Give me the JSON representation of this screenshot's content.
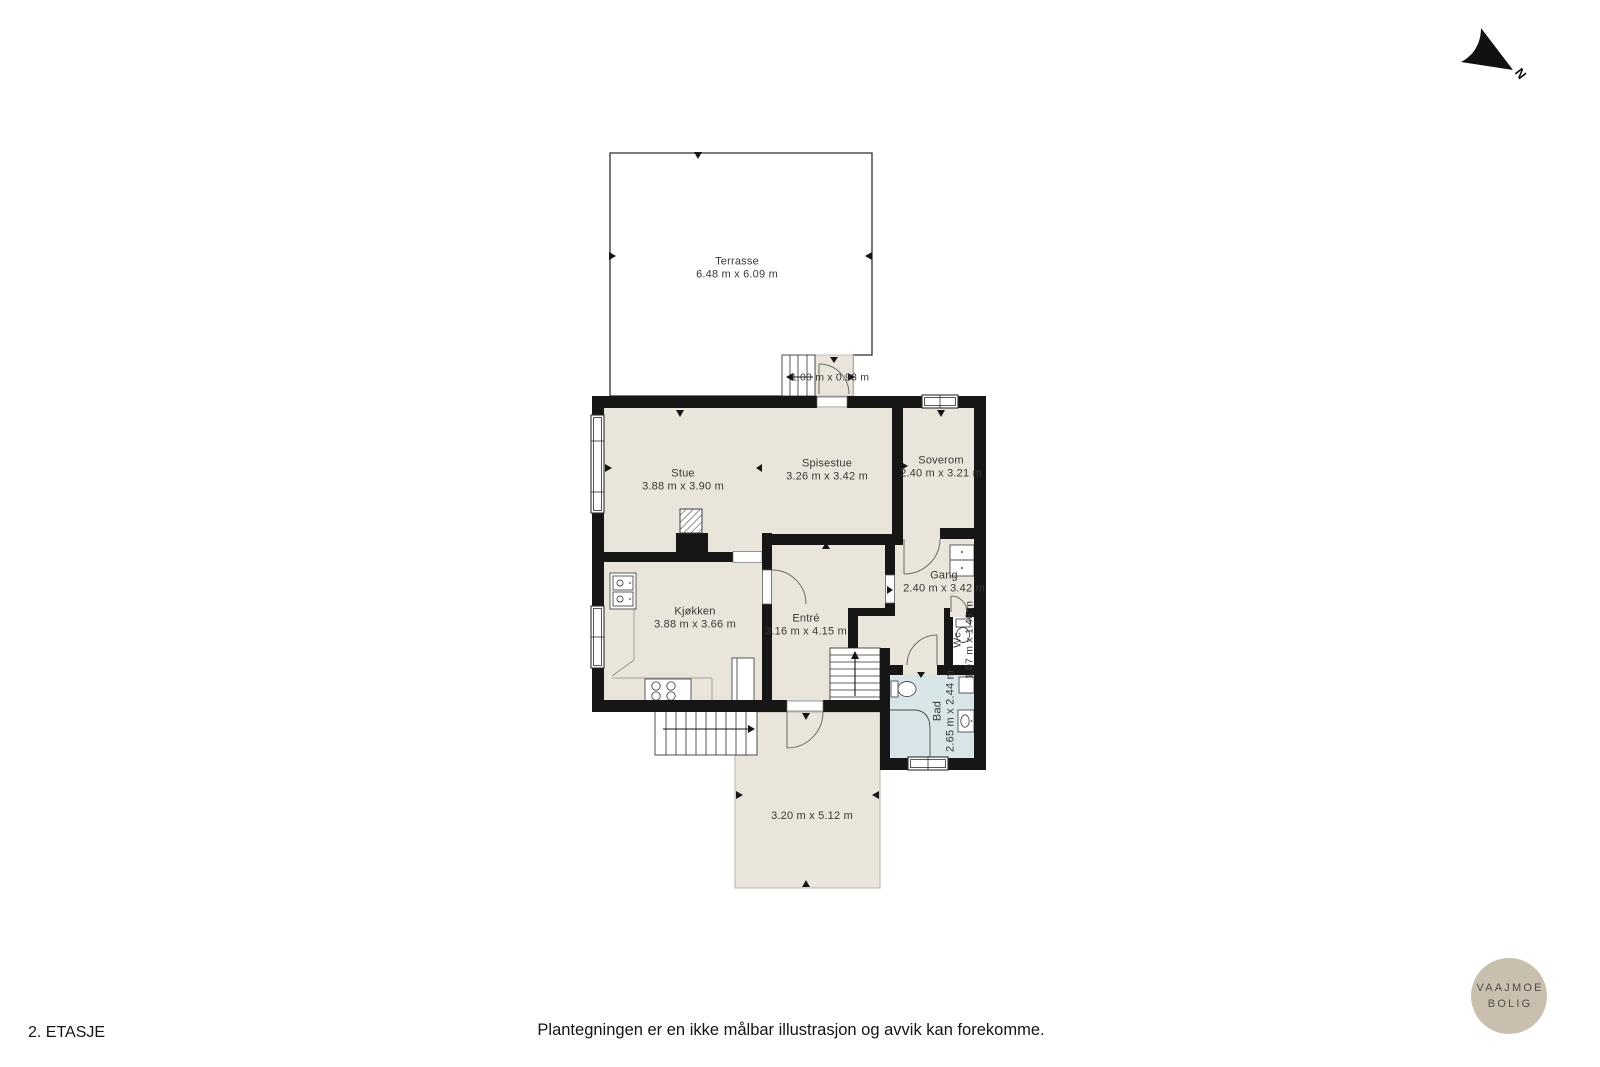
{
  "meta": {
    "floor_label": "2. ETASJE",
    "disclaimer": "Plantegningen er en ikke målbar illustrasjon og avvik kan forekomme.",
    "north_label": "N"
  },
  "logo": {
    "line1": "VAAJMOE",
    "line2": "BOLIG"
  },
  "colors": {
    "floor": "#eae5da",
    "bath_floor": "#d9e6e9",
    "wall": "#161616",
    "logo_bg": "#c8bfae",
    "logo_text": "#514e46"
  },
  "rooms": [
    {
      "id": "terrasse",
      "name": "Terrasse",
      "dims": "6.48 m x 6.09 m"
    },
    {
      "id": "terrasse-trapp",
      "name": "",
      "dims": "1.00 m x 0.93 m"
    },
    {
      "id": "stue",
      "name": "Stue",
      "dims": "3.88 m x 3.90 m"
    },
    {
      "id": "spisestue",
      "name": "Spisestue",
      "dims": "3.26 m x 3.42 m"
    },
    {
      "id": "soverom",
      "name": "Soverom",
      "dims": "2.40 m x 3.21 m"
    },
    {
      "id": "kjokken",
      "name": "Kjøkken",
      "dims": "3.88 m x 3.66 m"
    },
    {
      "id": "entre",
      "name": "Entré",
      "dims": "3.16 m x 4.15 m"
    },
    {
      "id": "gang",
      "name": "Gang",
      "dims": "2.40 m x 3.42 m"
    },
    {
      "id": "wc",
      "name": "Wc",
      "dims": "1.07 m x 1.46 m"
    },
    {
      "id": "bad",
      "name": "Bad",
      "dims": "2.65 m x 2.44 m"
    },
    {
      "id": "terrasse-nede",
      "name": "",
      "dims": "3.20 m x 5.12 m"
    }
  ]
}
